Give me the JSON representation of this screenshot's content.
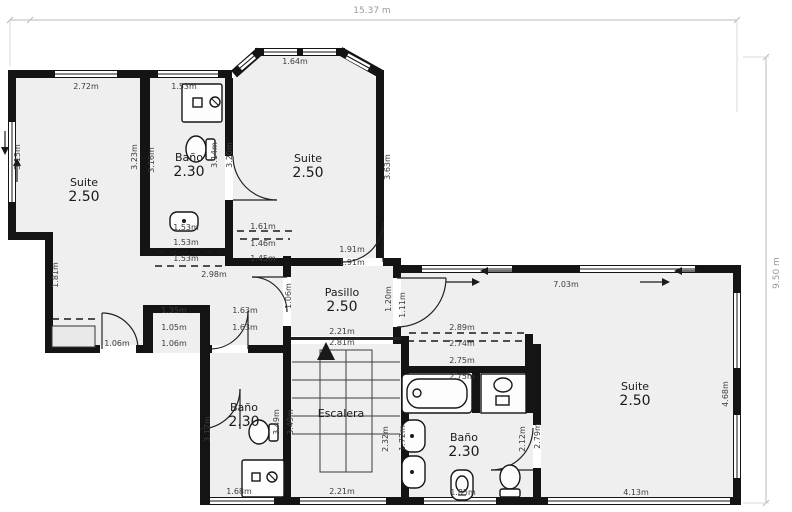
{
  "overall": {
    "width_label": "15.37 m",
    "height_label": "9.50 m"
  },
  "rooms": [
    {
      "name": "Suite",
      "value": "2.50",
      "location": "top-left"
    },
    {
      "name": "Baño",
      "value": "2.30",
      "location": "top-center"
    },
    {
      "name": "Suite",
      "value": "2.50",
      "location": "top-right"
    },
    {
      "name": "Pasillo",
      "value": "2.50",
      "location": "center"
    },
    {
      "name": "Escalera",
      "value": "",
      "location": "center-stairs"
    },
    {
      "name": "Baño",
      "value": "2.30",
      "location": "bottom-left"
    },
    {
      "name": "Baño",
      "value": "2.30",
      "location": "bottom-center"
    },
    {
      "name": "Suite",
      "value": "2.50",
      "location": "right"
    }
  ],
  "measurements": {
    "d272": "2.72m",
    "d153": "1.53m",
    "d164": "1.64m",
    "d315": "3.15m",
    "d323": "3.23m",
    "d316": "3.16m",
    "d314": "3.14m",
    "d320": "3.20m",
    "d363": "3.63m",
    "d161": "1.61m",
    "d146": "1.46m",
    "d145": "1.45m",
    "d298": "2.98m",
    "d191": "1.91m",
    "d181": "1.81m",
    "d135": "1.35m",
    "d105": "1.05m",
    "d106": "1.06m",
    "d163": "1.63m",
    "d221": "2.21m",
    "d281": "2.81m",
    "d349": "3.49m",
    "d232": "2.32m",
    "d317": "3.17m",
    "d172": "1.72m",
    "d212": "2.12m",
    "d279": "2.79m",
    "d289": "2.89m",
    "d274": "2.74m",
    "d275": "2.75m",
    "d703": "7.03m",
    "d468": "4.68m",
    "d413": "4.13m",
    "d168": "1.68m",
    "d185": "1.85m",
    "d111": "1.11m",
    "d120": "1.20m"
  },
  "icons": {
    "stairs-up-arrow": "▲",
    "window-slide-left": "←",
    "window-slide-right": "→"
  }
}
